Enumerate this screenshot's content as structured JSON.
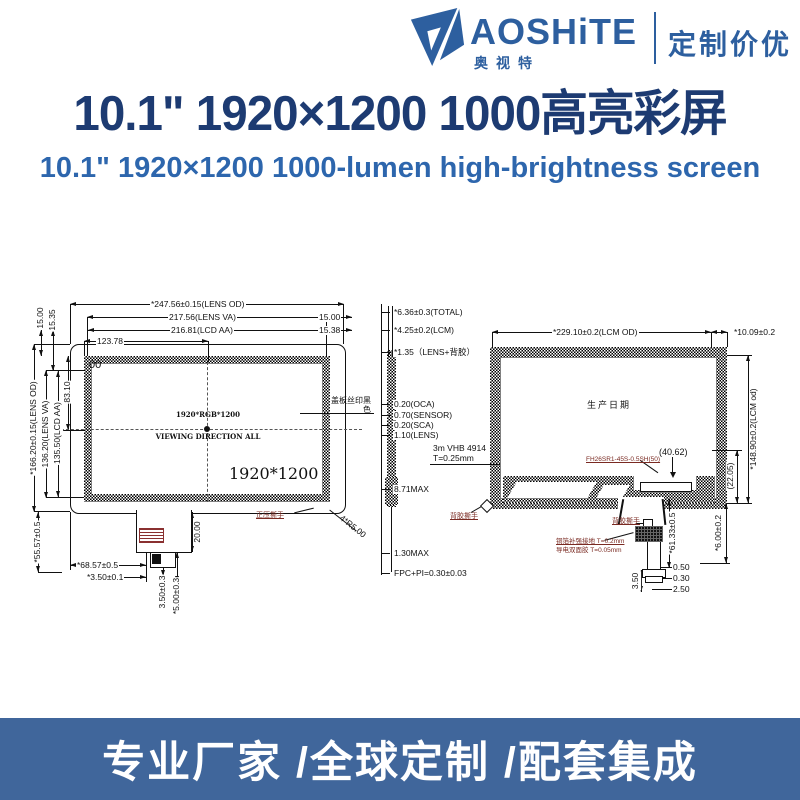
{
  "brand": {
    "name": "AOSHiTE",
    "name_cn": "奥视特",
    "tagline": "定制价优"
  },
  "title_cn": "10.1\" 1920×1200 1000高亮彩屏",
  "title_en": "10.1\" 1920×1200 1000-lumen high-brightness screen",
  "banner": "专业厂家 /全球定制 /配套集成",
  "colors": {
    "brand_blue": "#2d5f9f",
    "title_navy": "#1d3b72",
    "subtitle_blue": "#2d66ad",
    "banner_blue": "#40669b",
    "annotation_red": "#7a2a22"
  },
  "front": {
    "top": {
      "od": "*247.56±0.15(LENS OD)",
      "va": "217.56(LENS VA)",
      "aa": "216.81(LCD AA)",
      "half": "123.78",
      "m1": "15.00",
      "m2": "15.38"
    },
    "left": {
      "od": "*166.20±0.15(LENS OD)",
      "va": "136.20(LENS VA)",
      "aa": "135.50(LCD AA)",
      "half": "83.10",
      "m1": "15.00",
      "m2": "15.35",
      "tail": "*55.57±0.5"
    },
    "bottom": {
      "fpc_offset": "*68.57±0.5",
      "fpc_edge": "*3.50±0.1",
      "s1": "3.50±0.3",
      "s2": "*5.00±0.3",
      "tail_len": "20.00",
      "corner_r": "4*R5.00"
    },
    "corner_mark": "00",
    "center_res": "1920*RGB*1200",
    "viewing": "VIEWING DIRECTION ALL",
    "res": "1920*1200",
    "cover_note": "盖板丝印黑色",
    "tear_note": "正压撕手"
  },
  "side": {
    "total": "*6.36±0.3(TOTAL)",
    "lcm": "*4.25±0.2(LCM)",
    "lens_adhesive": "*1.35（LENS+背胶）",
    "oca": "0.20(OCA)",
    "sensor": "0.70(SENSOR)",
    "sca": "0.20(SCA)",
    "lens": "1.10(LENS)",
    "tape_line1": "3m VHB 4914",
    "tape_line2": "T=0.25mm",
    "stack_max": "8.71MAX",
    "fpc_max": "1.30MAX",
    "fpc_pi": "FPC+PI=0.30±0.03",
    "tear_note": "背胶撕手"
  },
  "rear": {
    "top_od": "*229.10±0.2(LCM OD)",
    "top_margin": "*10.09±0.2",
    "date_mark": "生产日期",
    "connector_pn": "FH26SR1-45S-0.5SH(50)",
    "connector_offset": "(40.62)",
    "height_od": "*148.90±0.2(LCM od)",
    "height_ref": "(22.05)",
    "bottom_margin": "*6.00±0.2",
    "fpc_len": "*61.33±0.5",
    "tear_note": "背胶撕手",
    "ground_note1": "铜箔补强接地 T=0.2mm",
    "ground_note2": "导电双面胶 T=0.05mm",
    "d050": "0.50",
    "d030": "0.30",
    "d250": "2.50",
    "d350": "3.50"
  }
}
